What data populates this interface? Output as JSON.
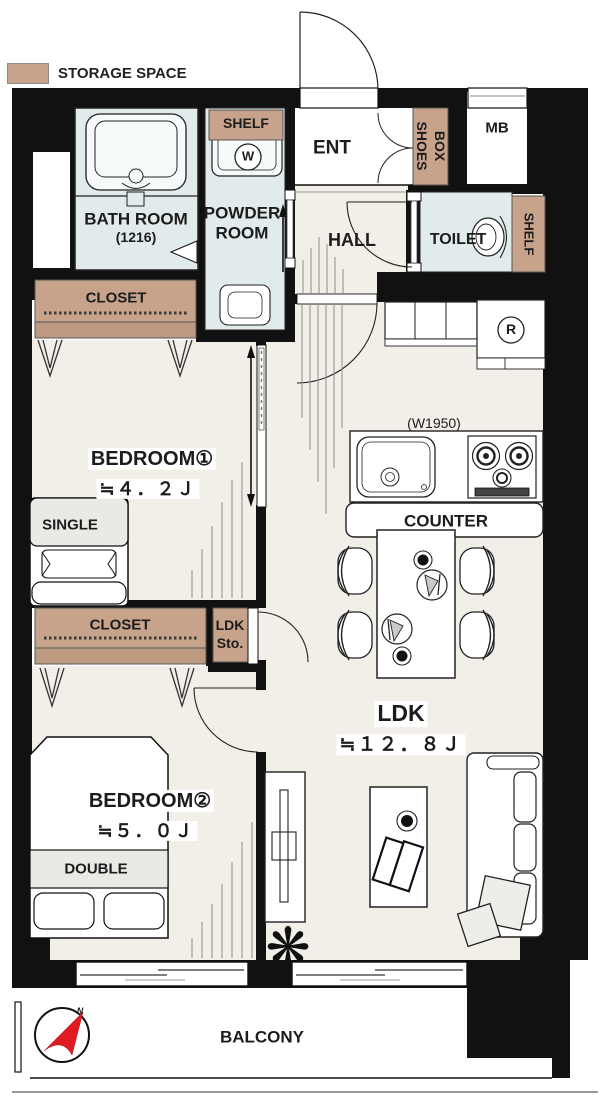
{
  "legend": {
    "storage_space": "STORAGE SPACE"
  },
  "colors": {
    "wall": "#111111",
    "floor": "#f1efe7",
    "storage": "#c7a38b",
    "storage_dark": "#bd9a81",
    "wet_area": "#e2ebeb",
    "fixture": "#f6fafa",
    "bedding_gray": "#e9e9e5",
    "compass_red": "#e11b22"
  },
  "rooms": {
    "bathroom": {
      "name": "BATH ROOM",
      "size": "(1216)"
    },
    "powder_room": {
      "line1": "POWDER",
      "line2": "ROOM",
      "shelf": "SHELF",
      "washer": "W"
    },
    "entrance": {
      "name": "ENT",
      "shoes_box_line1": "SHOES",
      "shoes_box_line2": "BOX"
    },
    "meter_box": {
      "name": "MB"
    },
    "hall": {
      "name": "HALL"
    },
    "toilet": {
      "name": "TOILET",
      "shelf": "SHELF"
    },
    "bedroom1": {
      "name": "BEDROOM①",
      "size": "≒４．２Ｊ",
      "closet": "CLOSET",
      "bed": "SINGLE"
    },
    "bedroom2": {
      "name": "BEDROOM②",
      "size": "≒５．０Ｊ",
      "closet": "CLOSET",
      "bed": "DOUBLE"
    },
    "ldk": {
      "name": "LDK",
      "size": "≒１２．８Ｊ",
      "counter": "COUNTER",
      "kitchen_width": "(W1950)",
      "fridge": "R",
      "storage_line1": "LDK",
      "storage_line2": "Sto."
    },
    "balcony": {
      "name": "BALCONY",
      "compass_north": "N"
    }
  }
}
